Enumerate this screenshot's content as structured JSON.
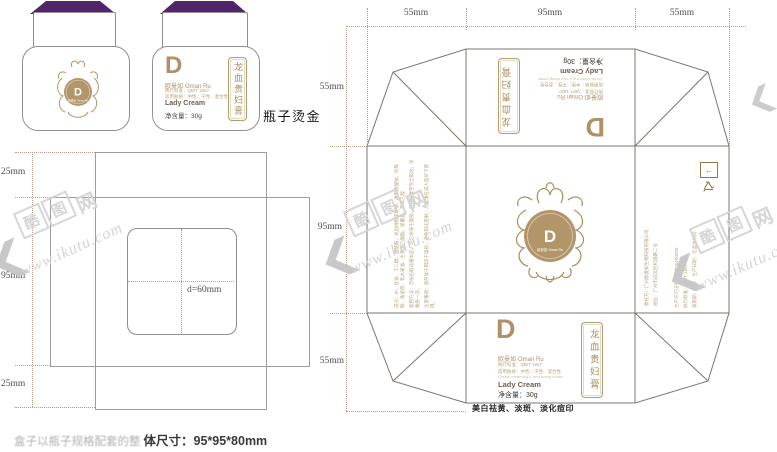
{
  "colors": {
    "purple": "#54246b",
    "gold": "#ae9166",
    "gold_dark": "#8d7b4e",
    "line_gray": "#9d9d9d",
    "fold_gray": "#7e746b"
  },
  "jars": {
    "hotstamp_note": "瓶子烫金",
    "monogram": "D",
    "label": {
      "brand_line": "欧曼如·Oman Ru",
      "fine_print_1": "执行标准：QB/T 1857",
      "fine_print_2": "适用肤质：中性、干性、混合性",
      "product_en": "Lady Cream",
      "net_weight": "净含量：30g",
      "product_name_vertical": "龙血贵妇膏"
    }
  },
  "label_dieline": {
    "dim_top": "25mm",
    "dim_middle": "95mm",
    "dim_bottom": "25mm",
    "dim_inner": "d=60mm"
  },
  "box_dieline": {
    "dims_top": [
      "55mm",
      "95mm",
      "55mm"
    ],
    "dims_left": [
      "55mm",
      "95mm",
      "55mm"
    ],
    "flap": {
      "monogram": "D",
      "brand_line": "欧曼如·Oman Ru",
      "fine_print_1": "执行标准：QB/T 1857",
      "fine_print_2": "适用肤质：中性、干性、混合性",
      "fine_print_3": "Gentle whitening & nourishing cream",
      "product_en": "Lady Cream",
      "net_weight": "净含量：30g",
      "product_name_vertical": "龙血贵妇膏"
    },
    "benefit_line": "美白祛黄、淡斑、淡化痘印",
    "center_logo": {
      "monogram": "D",
      "brand_line": "欧曼如·Oman Ru"
    },
    "left_panel": {
      "line1": "成分：水、甘油、丁二醇、烟酰胺、龙血树脂提取物、透明质酸钠、珍珠粉、角鲨烷、乳木果油、生育酚乙酸酯、尿囊素、苯氧乙醇",
      "line2": "使用方法：洁肤后取适量本品，均匀涂抹于面部，轻轻按摩至完全吸收，早晚各一次。",
      "line3": "注意事项：请存放于阴凉干燥处，避免阳光直射；儿童请在成人监护下使用。"
    },
    "right_panel": {
      "line1": "委托方：广州欧曼如生物科技有限公司",
      "line2": "地址：广州市白云区机场路二号",
      "line3": "生产许可证号：粤妆20160025",
      "line4": "执行标准：QB/T 1857",
      "line5": "保质期：三年　生产日期：见盒体喷码"
    }
  },
  "watermark": {
    "char1": "酷",
    "char2": "图",
    "char3": "网",
    "site": "www.ikutu.com"
  },
  "footer": {
    "faint_prefix": "盒子以瓶子规格配套的整",
    "size_text": "体尺寸：95*95*80mm"
  }
}
